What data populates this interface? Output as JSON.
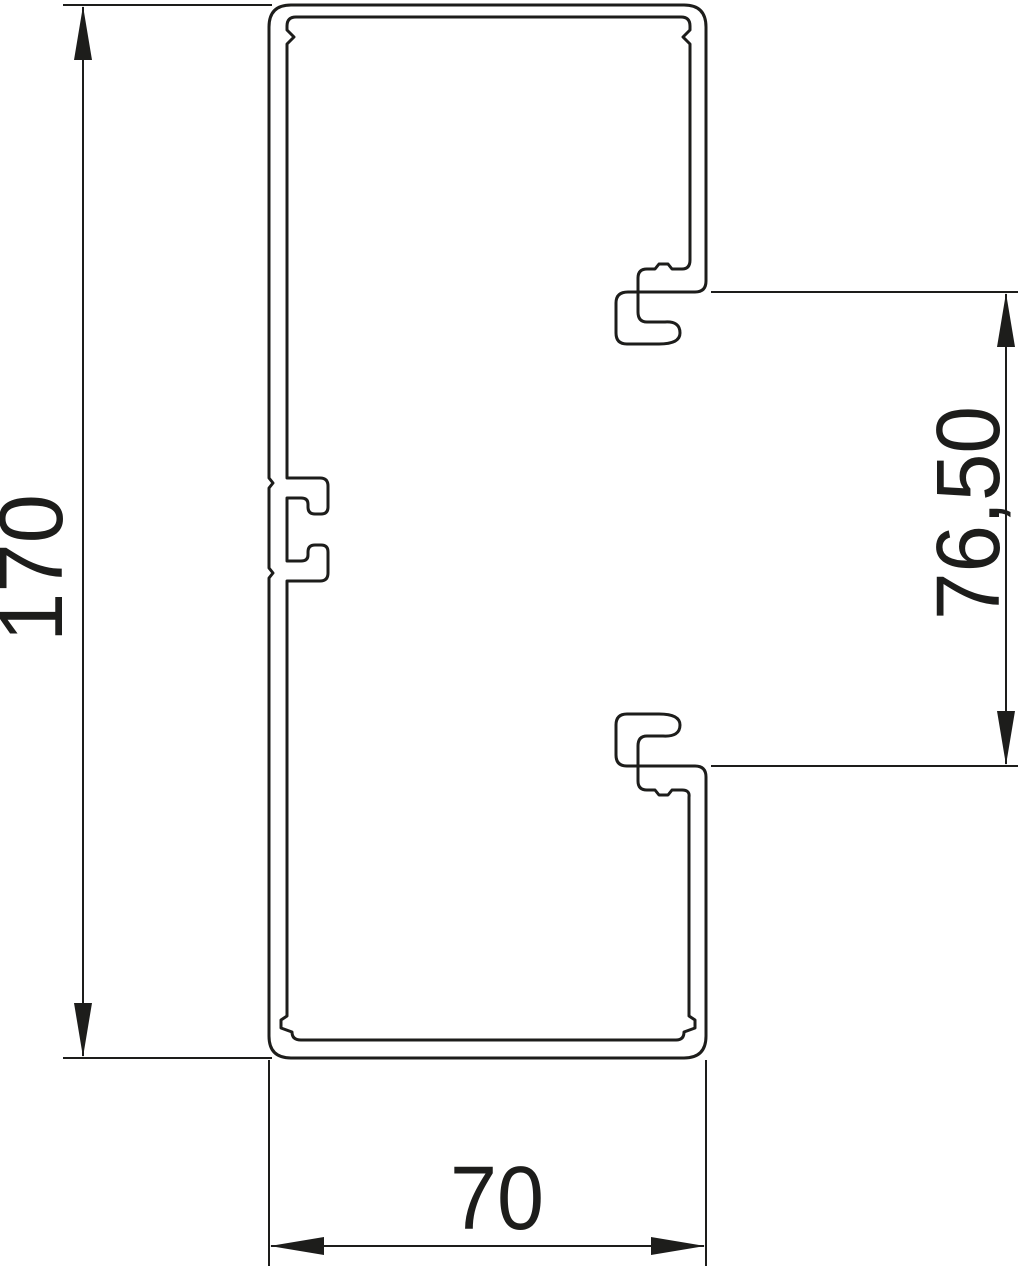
{
  "diagram": {
    "line_color": "#1d1d1b",
    "background": "#ffffff",
    "dimensions": {
      "height": {
        "label": "170"
      },
      "cover_opening": {
        "label": "76,50"
      },
      "width": {
        "label": "70"
      }
    }
  }
}
